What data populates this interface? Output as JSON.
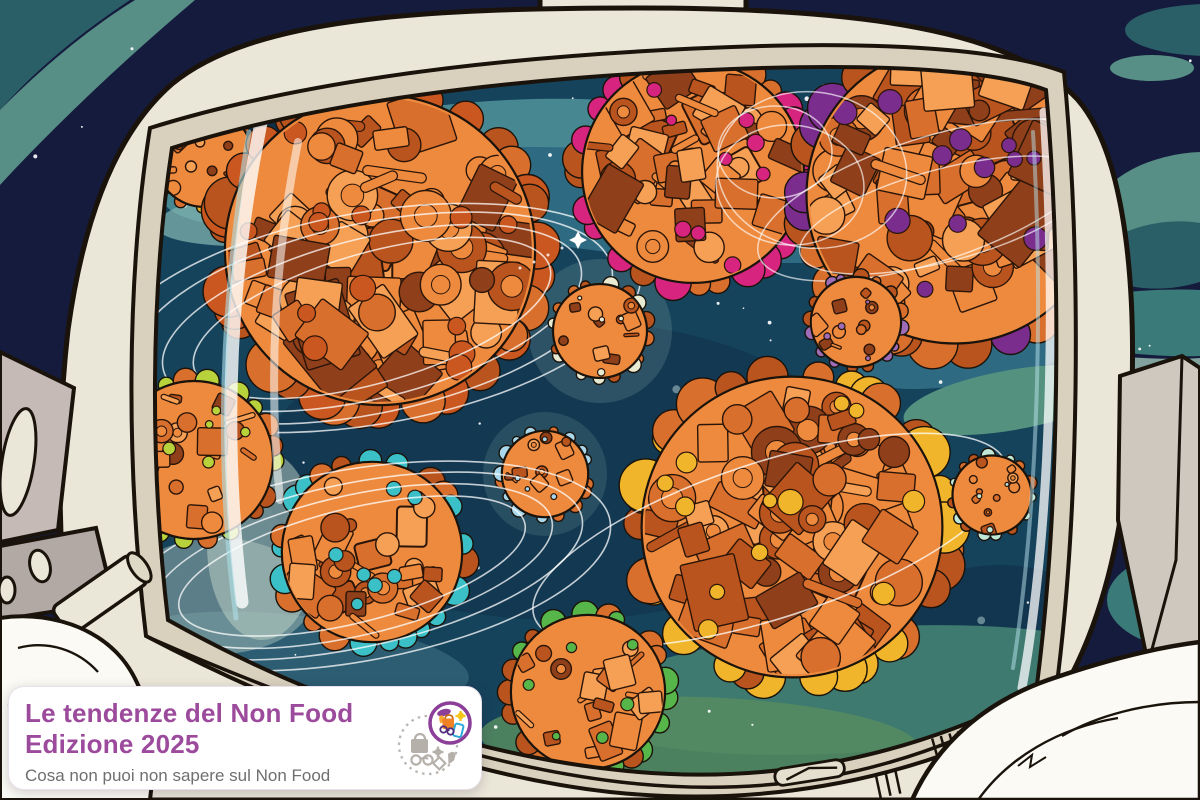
{
  "card": {
    "title_line1": "Le tendenze del Non Food",
    "title_line2": "Edizione 2025",
    "subtitle": "Cosa non puoi non sapere sul Non Food",
    "title_color": "#9c4a9c",
    "subtitle_color": "#6f6f6f"
  },
  "logo": {
    "ring_color": "#8b3f98",
    "bag_color": "#f08124",
    "gear_color": "#f5c518",
    "phone_color": "#2da8d8",
    "gray_icon_color": "#b5b0aa"
  },
  "palette": {
    "space_navy": "#151b3d",
    "swirl_teal_dark": "#2a5f68",
    "swirl_teal_light": "#578e85",
    "swirl_teal_band": "#3a7a78",
    "swirl_sage": "#9cc4b5",
    "visor_base": "#16435c",
    "visor_dark_patch": "#11304a",
    "visor_swirl1": "#2e6b82",
    "visor_swirl2": "#4f939b",
    "visor_swirl3": "#3e7a70",
    "visor_swirl4": "#568c60",
    "helmet_cream": "#eae6d8",
    "helmet_tan": "#d9d0bd",
    "outline": "#1a130b",
    "planet_orange": "#ee8a3e",
    "planet_orange_light": "#f5a055",
    "planet_orange_mid": "#d96f2c",
    "planet_orange_dark": "#b9541e",
    "planet_orange_deep": "#8f3f1a",
    "suit_white": "#fbfaf4",
    "backpack_gray": "#cfc8bf",
    "shelf_mauve": "#c5bab6",
    "shelf_taupe": "#b3a9a4",
    "star_white": "#ffffff",
    "star_glow": "#cfe8e2",
    "ring_white": "#ffffff"
  },
  "illustration": {
    "planets": [
      {
        "name": "hobby-planet",
        "x": 204,
        "y": 158,
        "r": 52,
        "accent": "#e3b52c"
      },
      {
        "name": "appliances-planet",
        "x": 380,
        "y": 250,
        "r": 165,
        "accent": "#c9571f",
        "ring_cx": 372,
        "ring_cy": 318,
        "rings": [
          [
            215,
            80,
            -14
          ],
          [
            245,
            95,
            -12
          ],
          [
            185,
            65,
            -16
          ],
          [
            272,
            106,
            -10
          ]
        ]
      },
      {
        "name": "beauty-planet",
        "x": 693,
        "y": 172,
        "r": 118,
        "accent": "#d6247f"
      },
      {
        "name": "furniture-planet",
        "x": 955,
        "y": 195,
        "r": 158,
        "accent": "#7b2d8e",
        "loops": [
          [
            812,
            170,
            95,
            78,
            8
          ],
          [
            790,
            185,
            74,
            60,
            4
          ],
          [
            775,
            152,
            57,
            46,
            0
          ],
          [
            930,
            200,
            180,
            62,
            -18
          ],
          [
            945,
            215,
            150,
            46,
            -15
          ]
        ]
      },
      {
        "name": "kitchenware-planet",
        "x": 600,
        "y": 331,
        "r": 50,
        "accent": "#e9ead2"
      },
      {
        "name": "personal-care-planet",
        "x": 856,
        "y": 322,
        "r": 48,
        "accent": "#9f6cb8"
      },
      {
        "name": "gadgets-planet",
        "x": 545,
        "y": 474,
        "r": 46,
        "accent": "#a9d8ec"
      },
      {
        "name": "sports-planet",
        "x": 372,
        "y": 552,
        "r": 96,
        "accent": "#3cc0c8",
        "ring_cx": 352,
        "ring_cy": 566,
        "rings": [
          [
            235,
            82,
            -12
          ],
          [
            205,
            70,
            -13
          ],
          [
            262,
            96,
            -10
          ],
          [
            178,
            57,
            -14
          ]
        ]
      },
      {
        "name": "fashion-planet",
        "x": 792,
        "y": 527,
        "r": 160,
        "accent": "#f0b52a",
        "ring_cx": 770,
        "ring_cy": 540,
        "rings": [
          [
            248,
            78,
            -18
          ]
        ]
      },
      {
        "name": "basket-planet",
        "x": 992,
        "y": 495,
        "r": 42,
        "accent": "#bfe8d9"
      },
      {
        "name": "media-planet",
        "x": 194,
        "y": 460,
        "r": 84,
        "accent": "#b8d23c"
      },
      {
        "name": "garden-planet",
        "x": 588,
        "y": 692,
        "r": 82,
        "accent": "#57b649"
      }
    ],
    "shooting_star": {
      "x": 578,
      "y": 240
    }
  }
}
